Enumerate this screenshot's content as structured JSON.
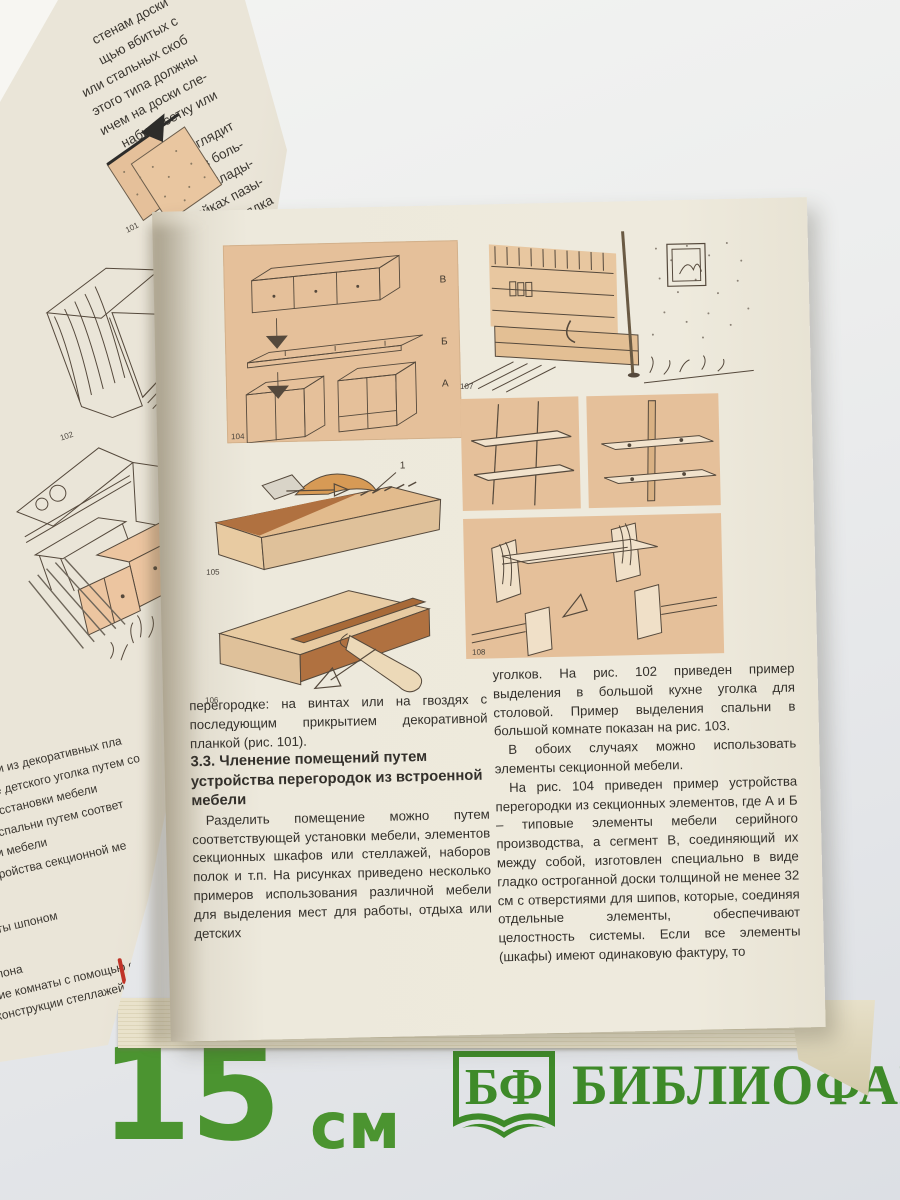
{
  "book": {
    "left_page": {
      "fragments": [
        "стенам доски",
        "щью вбитых с",
        "или стальных скоб",
        "этого типа должны",
        "ичем на доски сле-",
        "набить сетку или",
        "ектно выглядит",
        "я брусьев боль-",
        "торых вклады-",
        "стойках пазы-",
        "быть порядка",
        "от длины и",
        "брусья не",
        "ак клавиши",
        "ть специа-",
        "сторонам",
        "нам по-",
        "ами для",
        ". В слу-",
        "менять",
        "ую та-",
        "бить",
        "ой и",
        "у-",
        "ет",
        "о"
      ],
      "captions": [
        "ерегородки из декоративных пла",
        "ыделение детского уголка путем со",
        "ющей расстановки мебели",
        "еление спальни путем соответ",
        "тановки мебели",
        "ер  устройства  секционной  ме",
        "ки\")",
        "плиты шпоном",
        "шпона",
        "ние комнаты с помощью стел",
        "конструкции стеллажей"
      ],
      "figures": {
        "fig101": "101",
        "fig102": "102"
      }
    },
    "right_page": {
      "col1": {
        "para1": "перегородке: на винтах или на гвоздях с последующим прикрытием декоративной планкой (рис. 101).",
        "heading": "3.3. Членение помещений путем устройства перегородок из встроенной мебели",
        "para2": "Разделить помещение можно путем соответствующей установки мебели, элементов секционных шкафов или стеллажей, наборов полок и т.п. На рисунках приведено несколько примеров использования различной мебели для выделения мест для работы, отдыха или детских"
      },
      "col2": {
        "para1": "уголков. На рис. 102 приведен пример выделения в большой кухне уголка для столовой. Пример выделения спальни в большой комнате показан на рис. 103.",
        "para2": "В обоих случаях можно использовать элементы секционной мебели.",
        "para3": "На рис. 104 приведен пример устройства перегородки из секционных элементов, где А и Б – типовые элементы мебели серийного производства, а сегмент В, соединяющий их между собой, изготовлен специально в виде гладко остроганной доски толщиной не менее 32 см с отверстиями для шипов, которые, соединяя отдельные элементы, обеспечивают целостность системы. Если все элементы (шкафы) имеют одинаковую фактуру, то"
      },
      "figures": {
        "fig104": {
          "number": "104",
          "label_top": "В",
          "label_middle": "Б",
          "label_bottom": "А"
        },
        "fig105": {
          "number": "105",
          "callout": "1"
        },
        "fig106": {
          "number": "106"
        },
        "fig107": {
          "number": "107"
        },
        "fig108": {
          "number": "108"
        }
      }
    }
  },
  "footer": {
    "ruler_value": "15",
    "ruler_unit": "см",
    "logo_abbr": "БФ",
    "logo_name": "БИБЛИОФАН"
  },
  "colors": {
    "green": "#3e8a29",
    "panel_tan": "#e5c09a",
    "page_cream": "#ede9dc"
  }
}
